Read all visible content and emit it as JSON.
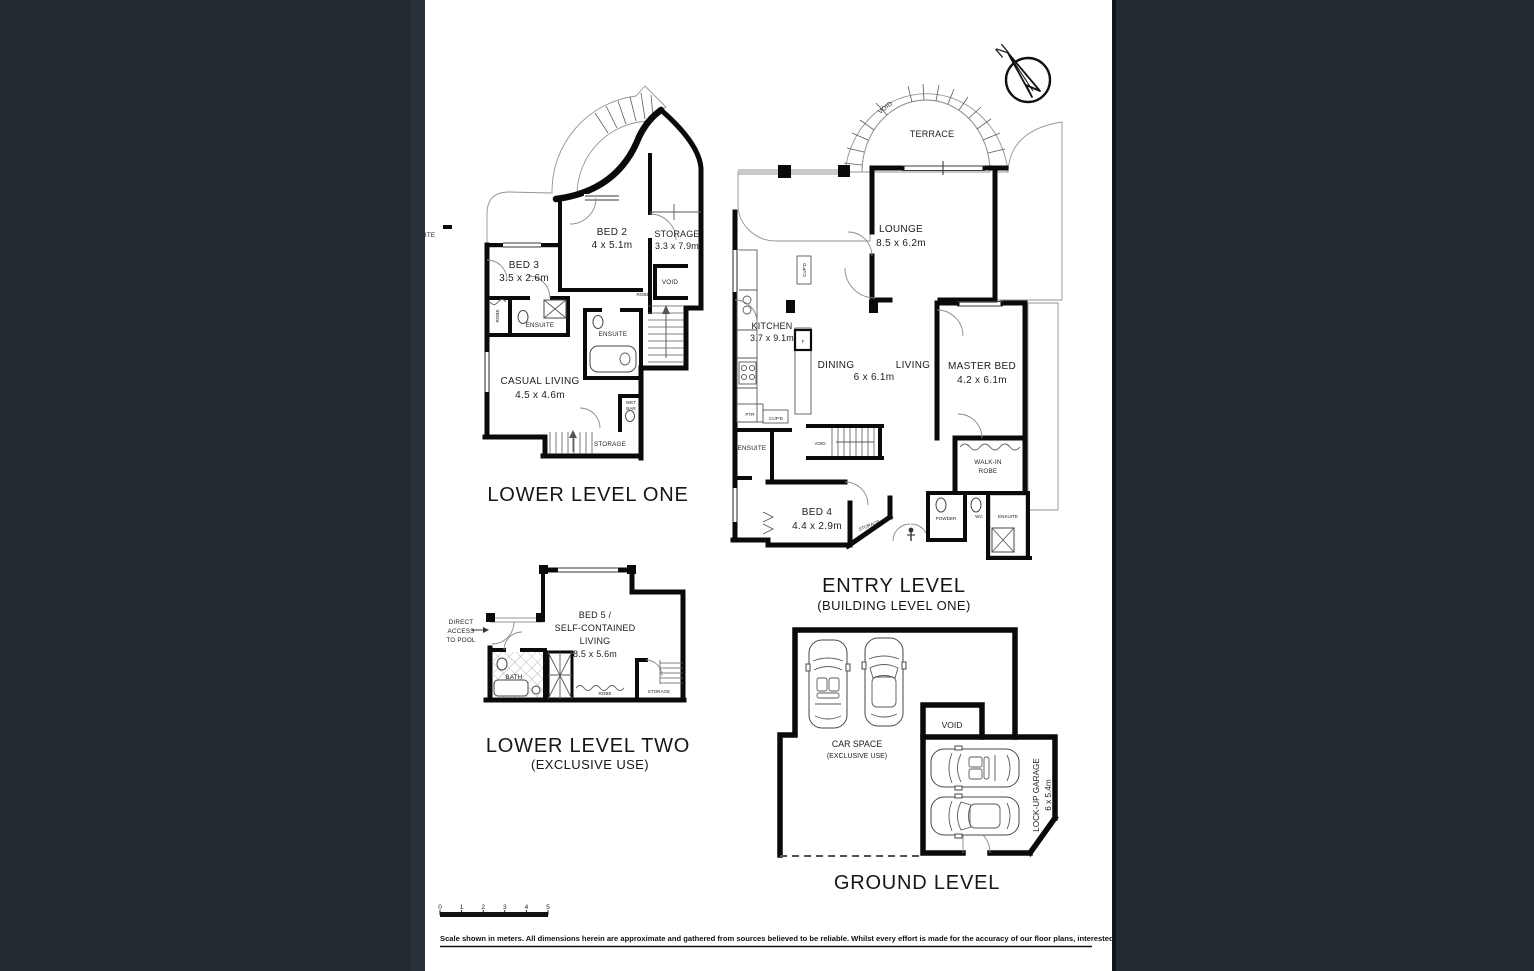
{
  "page": {
    "bg": "#222A32",
    "canvas": "#FFFFFF"
  },
  "compass": {
    "north": "N"
  },
  "ll1": {
    "title": "LOWER LEVEL ONE",
    "bed2_name": "BED 2",
    "bed2_dims": "4 x 5.1m",
    "bed3_name": "BED 3",
    "bed3_dims": "3.5 x 2.6m",
    "storage_name": "STORAGE",
    "storage_dims": "3.3 x 7.9m",
    "casual_name": "CASUAL LIVING",
    "casual_dims": "4.5 x 4.6m",
    "ensuite_a": "ENSUITE",
    "ensuite_b": "ENSUITE",
    "ensuite_edge": "ENSUITE",
    "void": "VOID",
    "robe_a": "ROBE",
    "robe_b": "ROBE",
    "wet": "WET",
    "bar": "BAR",
    "storage_small": "STORAGE"
  },
  "entry": {
    "title": "ENTRY LEVEL",
    "subtitle": "(BUILDING LEVEL ONE)",
    "terrace": "TERRACE",
    "terrace_void": "VOID",
    "lounge_name": "LOUNGE",
    "lounge_dims": "8.5 x 6.2m",
    "kitchen_name": "KITCHEN",
    "kitchen_dims": "3.7 x 9.1m",
    "dining": "DINING",
    "living": "LIVING",
    "dining_living_dims": "6 x 6.1m",
    "master_name": "MASTER BED",
    "master_dims": "4.2 x 6.1m",
    "walkin_line1": "WALK-IN",
    "walkin_line2": "ROBE",
    "ensuite_left": "ENSUITE",
    "ensuite_master": "ENSUITE",
    "bed4_name": "BED 4",
    "bed4_dims": "4.4 x 2.9m",
    "storage_small": "STORAGE",
    "powder": "POWDER",
    "wc": "WC",
    "stair_void": "VOID",
    "fridge": "F",
    "pantry": "PTR",
    "cupboard_a": "CUP'D",
    "cupboard_b": "CUP'D"
  },
  "ll2": {
    "title": "LOWER LEVEL TWO",
    "subtitle": "(EXCLUSIVE USE)",
    "access_line1": "DIRECT",
    "access_line2": "ACCESS",
    "access_line3": "TO POOL",
    "bed5_line1": "BED 5 /",
    "bed5_line2": "SELF-CONTAINED",
    "bed5_line3": "LIVING",
    "bed5_dims": "8.5 x 5.6m",
    "bath": "BATH",
    "robe": "ROBE",
    "storage": "STORAGE"
  },
  "ground": {
    "title": "GROUND LEVEL",
    "carspace_line1": "CAR SPACE",
    "carspace_line2": "(EXCLUSIVE  USE)",
    "void": "VOID",
    "garage_name": "LOCK-UP GARAGE",
    "garage_dims": "6 x 5.4m"
  },
  "scalebar": {
    "ticks": [
      "0",
      "1",
      "2",
      "3",
      "4",
      "5"
    ]
  },
  "disclaimer": "Scale shown in meters. All dimensions herein are approximate and gathered from sources believed to be  reliable. Whilst every effort is made for the accuracy of our floor plans, interested parties should rely on their own enquiries."
}
